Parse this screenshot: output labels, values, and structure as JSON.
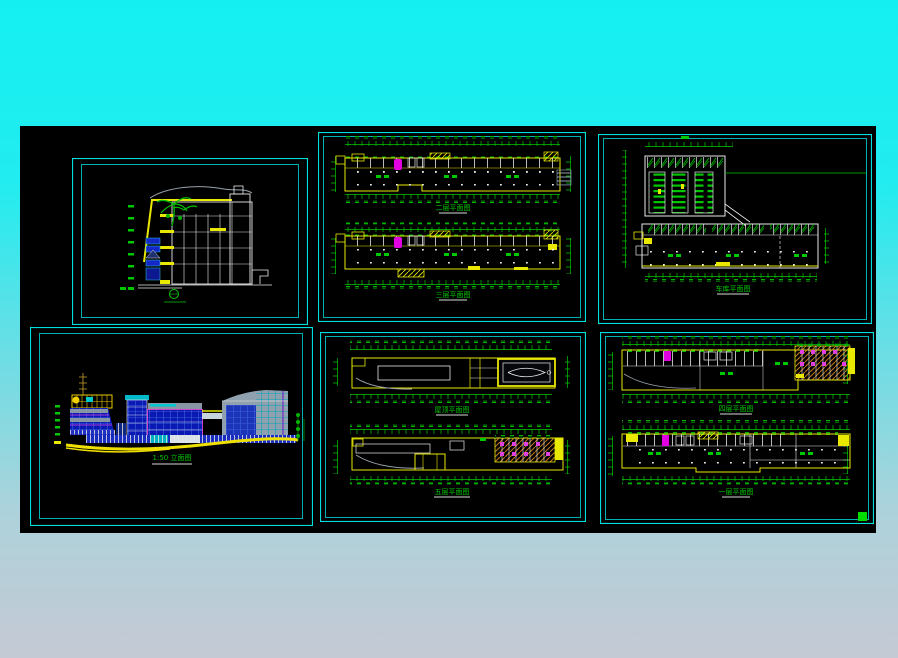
{
  "colors": {
    "background_top": "#14f0f2",
    "background_bottom": "#c4c9d4",
    "canvas_black": "#000000",
    "frame_cyan": "#00dede",
    "line_yellow": "#e8e800",
    "line_green": "#00c800",
    "line_white": "#e8e8e8",
    "line_magenta": "#e000e0",
    "facade_blue": "#0a18b4",
    "facade_gray": "#8f9fae",
    "hatch_orange": "#c07818",
    "grip_green": "#00dc00"
  },
  "panels": {
    "upper_plans": {
      "plan1_title": "二层平面图",
      "plan2_title": "三层平面图"
    },
    "parking_plan": {
      "title": "车库平面图"
    },
    "elevation": {
      "title": "1:50 立面图"
    },
    "mid_plans": {
      "plan1_title": "屋顶平面图",
      "plan2_title": "五层平面图"
    },
    "lower_plans": {
      "plan1_title": "四层平面图",
      "plan2_title": "一层平面图"
    }
  }
}
